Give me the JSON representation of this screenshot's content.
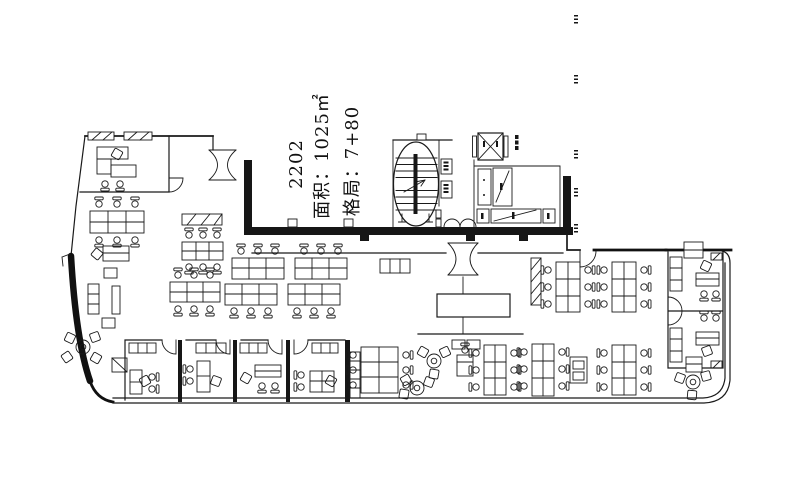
{
  "page": {
    "background": "#ffffff",
    "line_color": "#1a1a1a"
  },
  "labels": {
    "unit_number": "2202",
    "area": "面积：1025㎡",
    "layout": "格局：7+80"
  },
  "plan_elements": [
    "staircase",
    "elevator-shaft",
    "washroom-fixtures",
    "entrance-double-door",
    "lobby-double-door",
    "reception-table",
    "open-plan-desk-clusters",
    "private-offices",
    "round-meeting-tables",
    "printer-station"
  ]
}
